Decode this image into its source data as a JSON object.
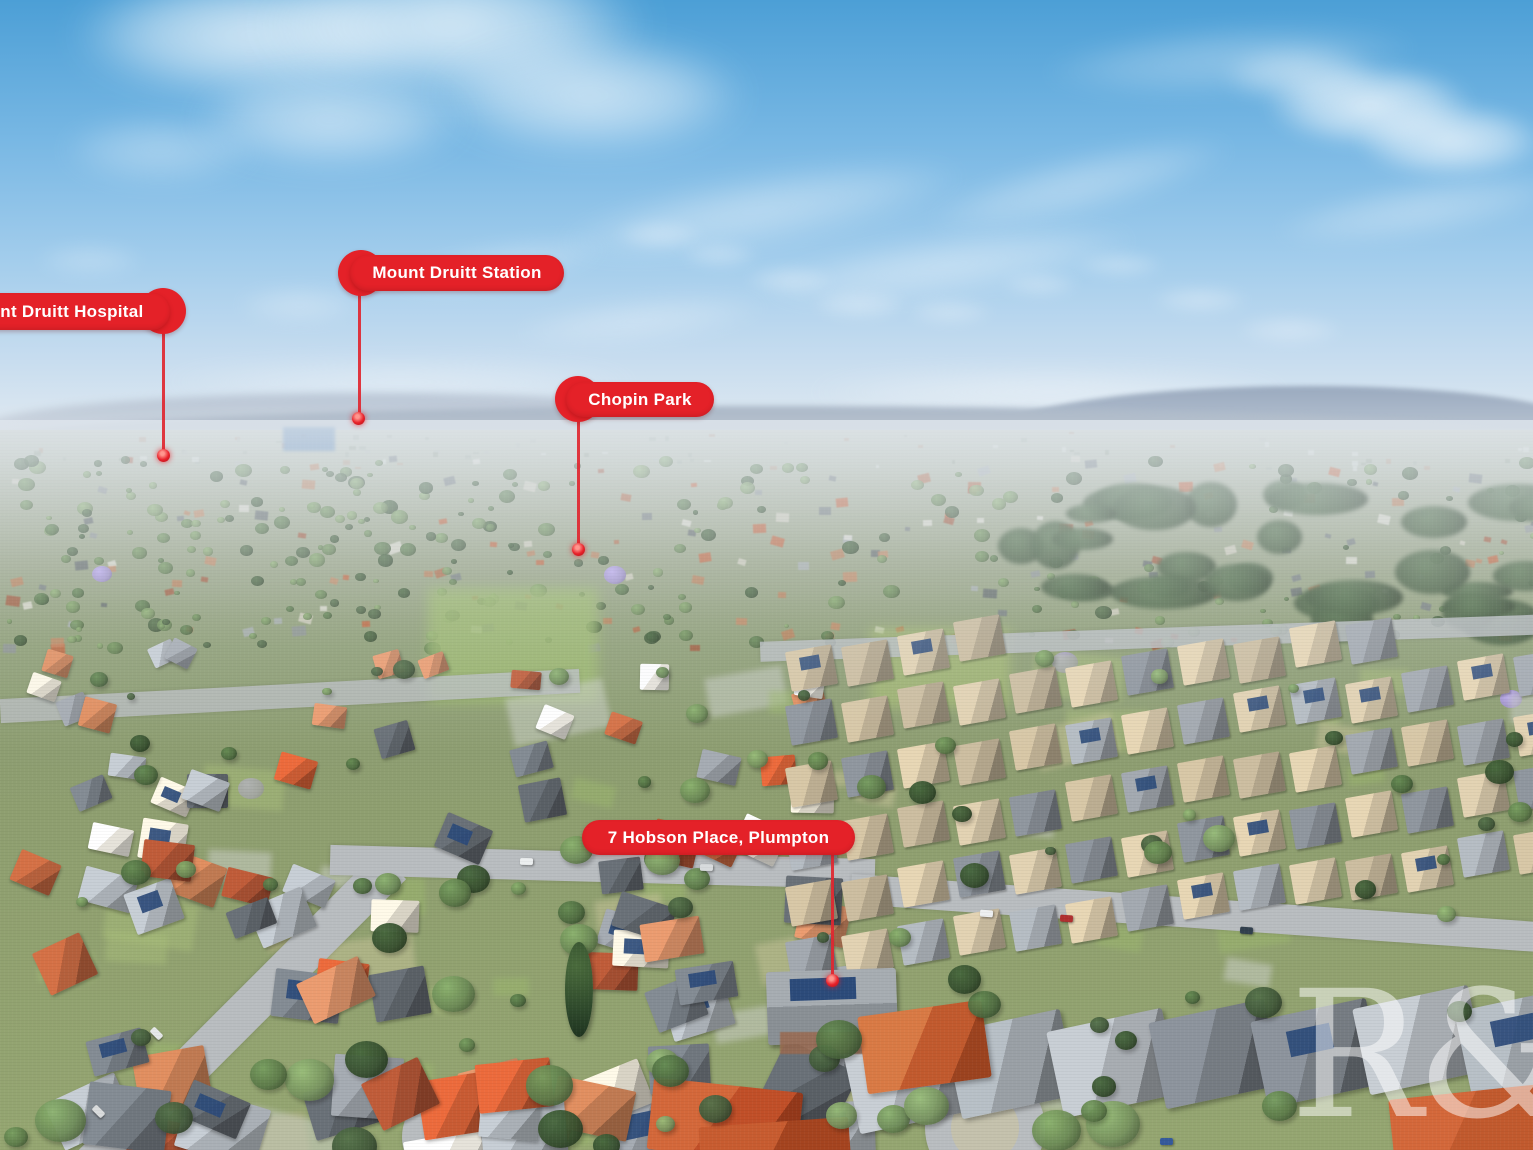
{
  "scene": {
    "watermark_text": "R&",
    "palette": {
      "marker_red": "#e42128",
      "marker_line": "#df2730",
      "road": "#b9bdc0",
      "court": "#c6c2ab",
      "solar": "#2c4b7a",
      "jacaranda": "#a08fd0",
      "forest": "#41573a",
      "roofs_old": [
        "#b5603c",
        "#c07a52",
        "#a34e31",
        "#8d9298",
        "#70777e",
        "#aab0b6",
        "#e6e3da",
        "#d9d4c6",
        "#5a6066",
        "#c8855f",
        "#c95b33"
      ],
      "roofs_estate": [
        "#c6b89c",
        "#bcae92",
        "#8f949a",
        "#9fa5ab",
        "#b3a68c",
        "#7e848b",
        "#cabb9e"
      ],
      "roofs_big": [
        "#888e94",
        "#9aa0a6",
        "#767c83",
        "#a8adb2"
      ],
      "trees": [
        "#4e6b40",
        "#5d7b4a",
        "#6c8a56",
        "#42593a",
        "#77935f",
        "#37502f"
      ],
      "patches": [
        "#a8bd7a",
        "#c9c49b",
        "#cfd2cd",
        "#9cb86e",
        "#b7b083"
      ]
    }
  },
  "markers": [
    {
      "id": "mount-druitt-hospital",
      "label": "Mount Druitt Hospital",
      "pill": {
        "left": -62,
        "top": 293,
        "width": 232,
        "height": 37
      },
      "circle": {
        "cx": 163,
        "cy": 311,
        "d": 46
      },
      "line": {
        "x": 163,
        "y1": 330,
        "y2": 452
      },
      "dot": {
        "cx": 163,
        "cy": 455
      }
    },
    {
      "id": "mount-druitt-station",
      "label": "Mount Druitt Station",
      "pill": {
        "left": 350,
        "top": 255,
        "width": 214,
        "height": 36
      },
      "circle": {
        "cx": 361,
        "cy": 273,
        "d": 46
      },
      "line": {
        "x": 359,
        "y1": 294,
        "y2": 415
      },
      "dot": {
        "cx": 358,
        "cy": 418
      }
    },
    {
      "id": "chopin-park",
      "label": "Chopin Park",
      "pill": {
        "left": 566,
        "top": 382,
        "width": 148,
        "height": 35
      },
      "circle": {
        "cx": 578,
        "cy": 399,
        "d": 46
      },
      "line": {
        "x": 578,
        "y1": 420,
        "y2": 546
      },
      "dot": {
        "cx": 578,
        "cy": 549
      }
    },
    {
      "id": "subject-property",
      "label": "7 Hobson Place, Plumpton",
      "pill": {
        "left": 582,
        "top": 820,
        "width": 273,
        "height": 35
      },
      "circle": null,
      "line": {
        "x": 832,
        "y1": 853,
        "y2": 977
      },
      "dot": {
        "cx": 832,
        "cy": 980
      }
    }
  ]
}
